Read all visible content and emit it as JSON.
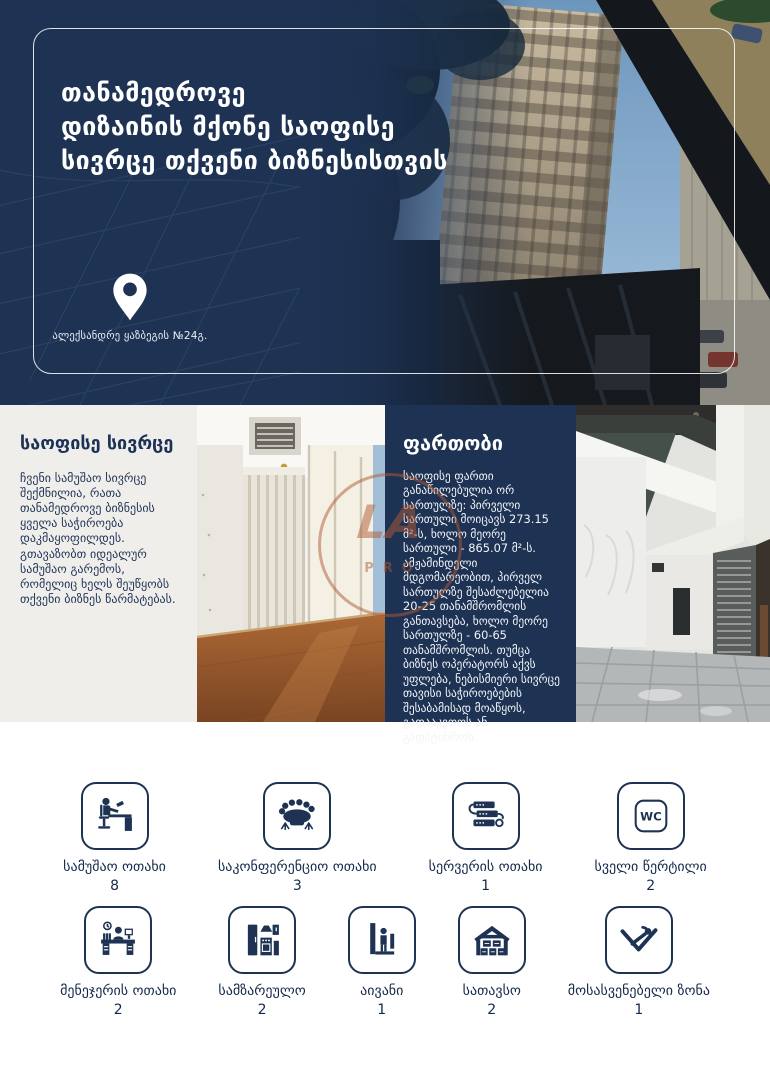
{
  "hero": {
    "title_lines": [
      "თანამედროვე",
      "დიზაინის მქონე საოფისე",
      "სივრცე თქვენი ბიზნესისთვის"
    ],
    "address": "ალექსანდრე ყაზბეგის №24გ.",
    "pin_icon": "location-pin-icon"
  },
  "sections": {
    "office_space": {
      "heading": "საოფისე სივრცე",
      "body": "ჩვენი სამუშაო სივრცე შექმნილია, რათა თანამედროვე ბიზნესის ყველა საჭიროება დაკმაყოფილდეს. გთავაზობთ იდეალურ სამუშაო გარემოს, რომელიც ხელს შეუწყობს თქვენი ბიზნეს წარმატებას."
    },
    "area": {
      "heading": "ფართობი",
      "body": "საოფისე ფართი განაწილებულია ორ სართულზე: პირველი სართული მოიცავს 273.15 მ²-ს, ხოლო მეორე სართული - 865.07 მ²-ს. ამჟამინდელი მდგომარეობით, პირველ სართულზე შესაძლებელია 20-25 თანამშრომლის განთავსება, ხოლო მეორე სართულზე - 60-65 თანამშრომლის. თუმცა ბიზნეს ოპერატორს აქვს უფლება, ნებისმიერი სივრცე თავისი საჭიროებების შესაბამისად მოაწყოს, გადააკეთოს ან გადატიხროს."
    }
  },
  "watermark": {
    "monogram": "LA",
    "subtext": "PRO",
    "color": "#b05a36"
  },
  "amenities": {
    "wc_text": "WC",
    "row1": [
      {
        "label": "სამუშაო ოთახი",
        "count": "8",
        "icon": "workstation-icon"
      },
      {
        "label": "საკონფერენციო ოთახი",
        "count": "3",
        "icon": "conference-room-icon"
      },
      {
        "label": "სერვერის ოთახი",
        "count": "1",
        "icon": "server-icon"
      },
      {
        "label": "სველი წერტილი",
        "count": "2",
        "icon": "wc-icon"
      }
    ],
    "row2": [
      {
        "label": "მენეჯერის ოთახი",
        "count": "2",
        "icon": "manager-office-icon"
      },
      {
        "label": "სამზარეულო",
        "count": "2",
        "icon": "kitchen-icon"
      },
      {
        "label": "აივანი",
        "count": "1",
        "icon": "balcony-icon"
      },
      {
        "label": "სათავსო",
        "count": "2",
        "icon": "storage-icon"
      },
      {
        "label": "მოსასვენებელი ზონა",
        "count": "1",
        "icon": "rest-zone-icon"
      }
    ]
  },
  "colors": {
    "navy": "#1e3354",
    "panel_light": "#f0eeea",
    "watermark": "#b05a36",
    "floor_wood": "#9a5a33"
  }
}
